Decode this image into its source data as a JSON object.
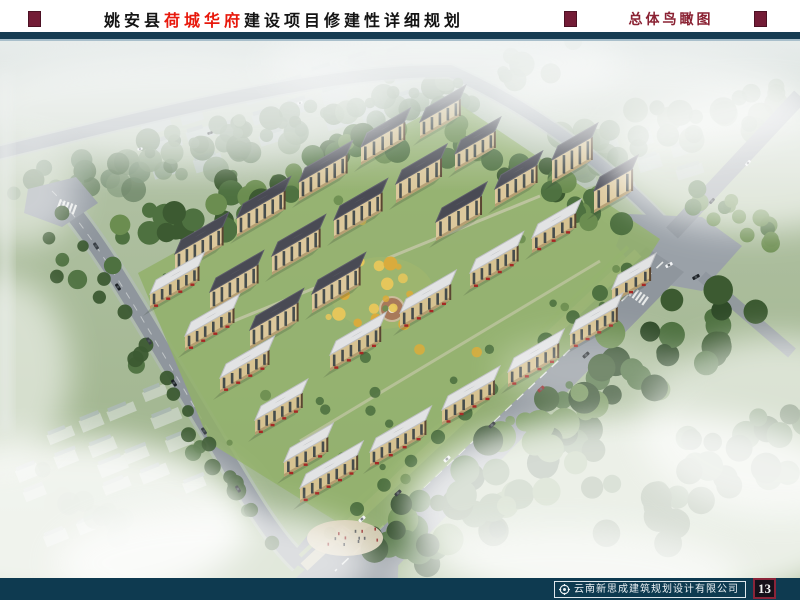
{
  "header": {
    "title": {
      "prefix": "姚安县",
      "highlight": "荷城华府",
      "suffix": "建设项目修建性详细规划"
    },
    "section_label": "总体鸟瞰图",
    "title_color": "#141414",
    "highlight_color": "#e8190c",
    "section_color": "#8a2233",
    "marker_color": "#731c36",
    "rule_color": "#173c52"
  },
  "rendering": {
    "description": "总体鸟瞰图 aerial bird's-eye rendering of the 荷城华府 residential development: rows of beige mid-rise apartment slabs with dark roofs, white-roofed street-front commercial buildings, surrounding roads, dense green forest and drifting white mist",
    "colors": {
      "mist": "#e8edec",
      "landTop": "#cfd7d4",
      "landMid": "#aebfa0",
      "landLow": "#9cb288",
      "bgBuilding": "#c4cdd3",
      "bgBuildingRoof": "#aeb9c0",
      "ctxBuilding": "#d5dcd4",
      "forestDark": "#3c5a31",
      "forestMid": "#4e7140",
      "forestLight": "#6b8d50",
      "bgForest": "#7e957a",
      "road": "#8f969d",
      "roadLight": "#9aa1a8",
      "roadEdge": "#b5bcbf",
      "laneLine": "#f2f4f2",
      "sidewalk": "#cfc9b2",
      "verge": "#aabf8b",
      "plaza": "#d8cdb4",
      "roofDark": "#494a54",
      "roofDarkHi": "#5c5d68",
      "roofLight": "#e2e3e4",
      "roofLightShade": "#bfc1c4",
      "facade": "#dcc89c",
      "facadeShade": "#ab9368",
      "windowColor": "#2c3840",
      "endCap": "#5a4632",
      "lawn": "#92b06a",
      "autumn1": "#dcab3a",
      "autumn2": "#e9c75a",
      "awning": "#a62824",
      "carWhite": "#f2f4f6",
      "carDark": "#1d2226",
      "carRed": "#8e1f1f",
      "fog": "#ffffff",
      "shadow": "#2d3a2d"
    }
  },
  "footer": {
    "bar_color": "#0e3a50",
    "company": "云南新思成建筑规划设计有限公司",
    "page_number": "13",
    "logo": "compass-icon"
  }
}
